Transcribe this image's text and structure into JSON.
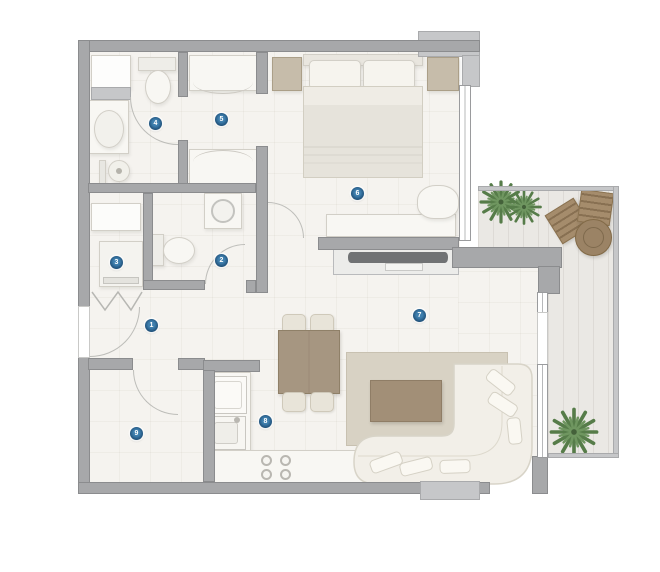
{
  "title": "Apartment floor plan",
  "colors": {
    "wall": "#a7a8aa",
    "wallEdge": "#8b8c8e",
    "wallLight": "#c6c7c9",
    "floor": "#f5f3ef",
    "floorLine": "rgba(125,115,95,0.06)",
    "balconyFloor": "#eae8e4",
    "balconyLine": "rgba(105,98,85,0.10)",
    "furnWhite": "#f8f7f3",
    "furnEdge": "#d2cfc7",
    "beige": "#c6bcaa",
    "beigeEdge": "#ab9f88",
    "rug": "#d8d2c4",
    "rugEdge": "#c8c1b1",
    "tableWood": "#a69681",
    "tableWoodEdge": "#8f8068",
    "coffeeWood": "#a28f77",
    "coffeeWoodEdge": "#8f7d66",
    "outdoorWood": "#a58c6c",
    "outdoorWoodEdge": "#8a7250",
    "tv": "#707274",
    "plantGreen": "#567c49",
    "plantGreenLight": "#6f9660",
    "marker": "#1e4f78",
    "markerCenter": "#3f7fae",
    "markerText": "#ffffff",
    "doorArc": "#bdbdb9",
    "windowEdge": "#9a9b9d"
  },
  "markers": [
    {
      "label": "1",
      "room": "entry-hall",
      "x": 152,
      "y": 326
    },
    {
      "label": "2",
      "room": "wc",
      "x": 222,
      "y": 261
    },
    {
      "label": "3",
      "room": "utility-closet",
      "x": 117,
      "y": 263
    },
    {
      "label": "4",
      "room": "bathroom",
      "x": 156,
      "y": 124
    },
    {
      "label": "5",
      "room": "dressing-area",
      "x": 222,
      "y": 120
    },
    {
      "label": "6",
      "room": "bedroom",
      "x": 358,
      "y": 194
    },
    {
      "label": "7",
      "room": "living-room",
      "x": 420,
      "y": 316
    },
    {
      "label": "8",
      "room": "kitchen",
      "x": 266,
      "y": 422
    },
    {
      "label": "9",
      "room": "store-room",
      "x": 137,
      "y": 434
    }
  ],
  "furniture": [
    "double-bed",
    "pillows",
    "nightstands",
    "desk",
    "desk-chair",
    "wardrobes",
    "washing-machine",
    "toilets",
    "washbasin",
    "shower",
    "washer-dryer",
    "shelf",
    "fridge",
    "kitchen-sink",
    "stove",
    "kitchen-counter",
    "dining-table",
    "dining-chairs",
    "corner-sofa",
    "coffee-table",
    "rug",
    "tv-console",
    "tv",
    "outdoor-chairs",
    "outdoor-table",
    "plants"
  ]
}
